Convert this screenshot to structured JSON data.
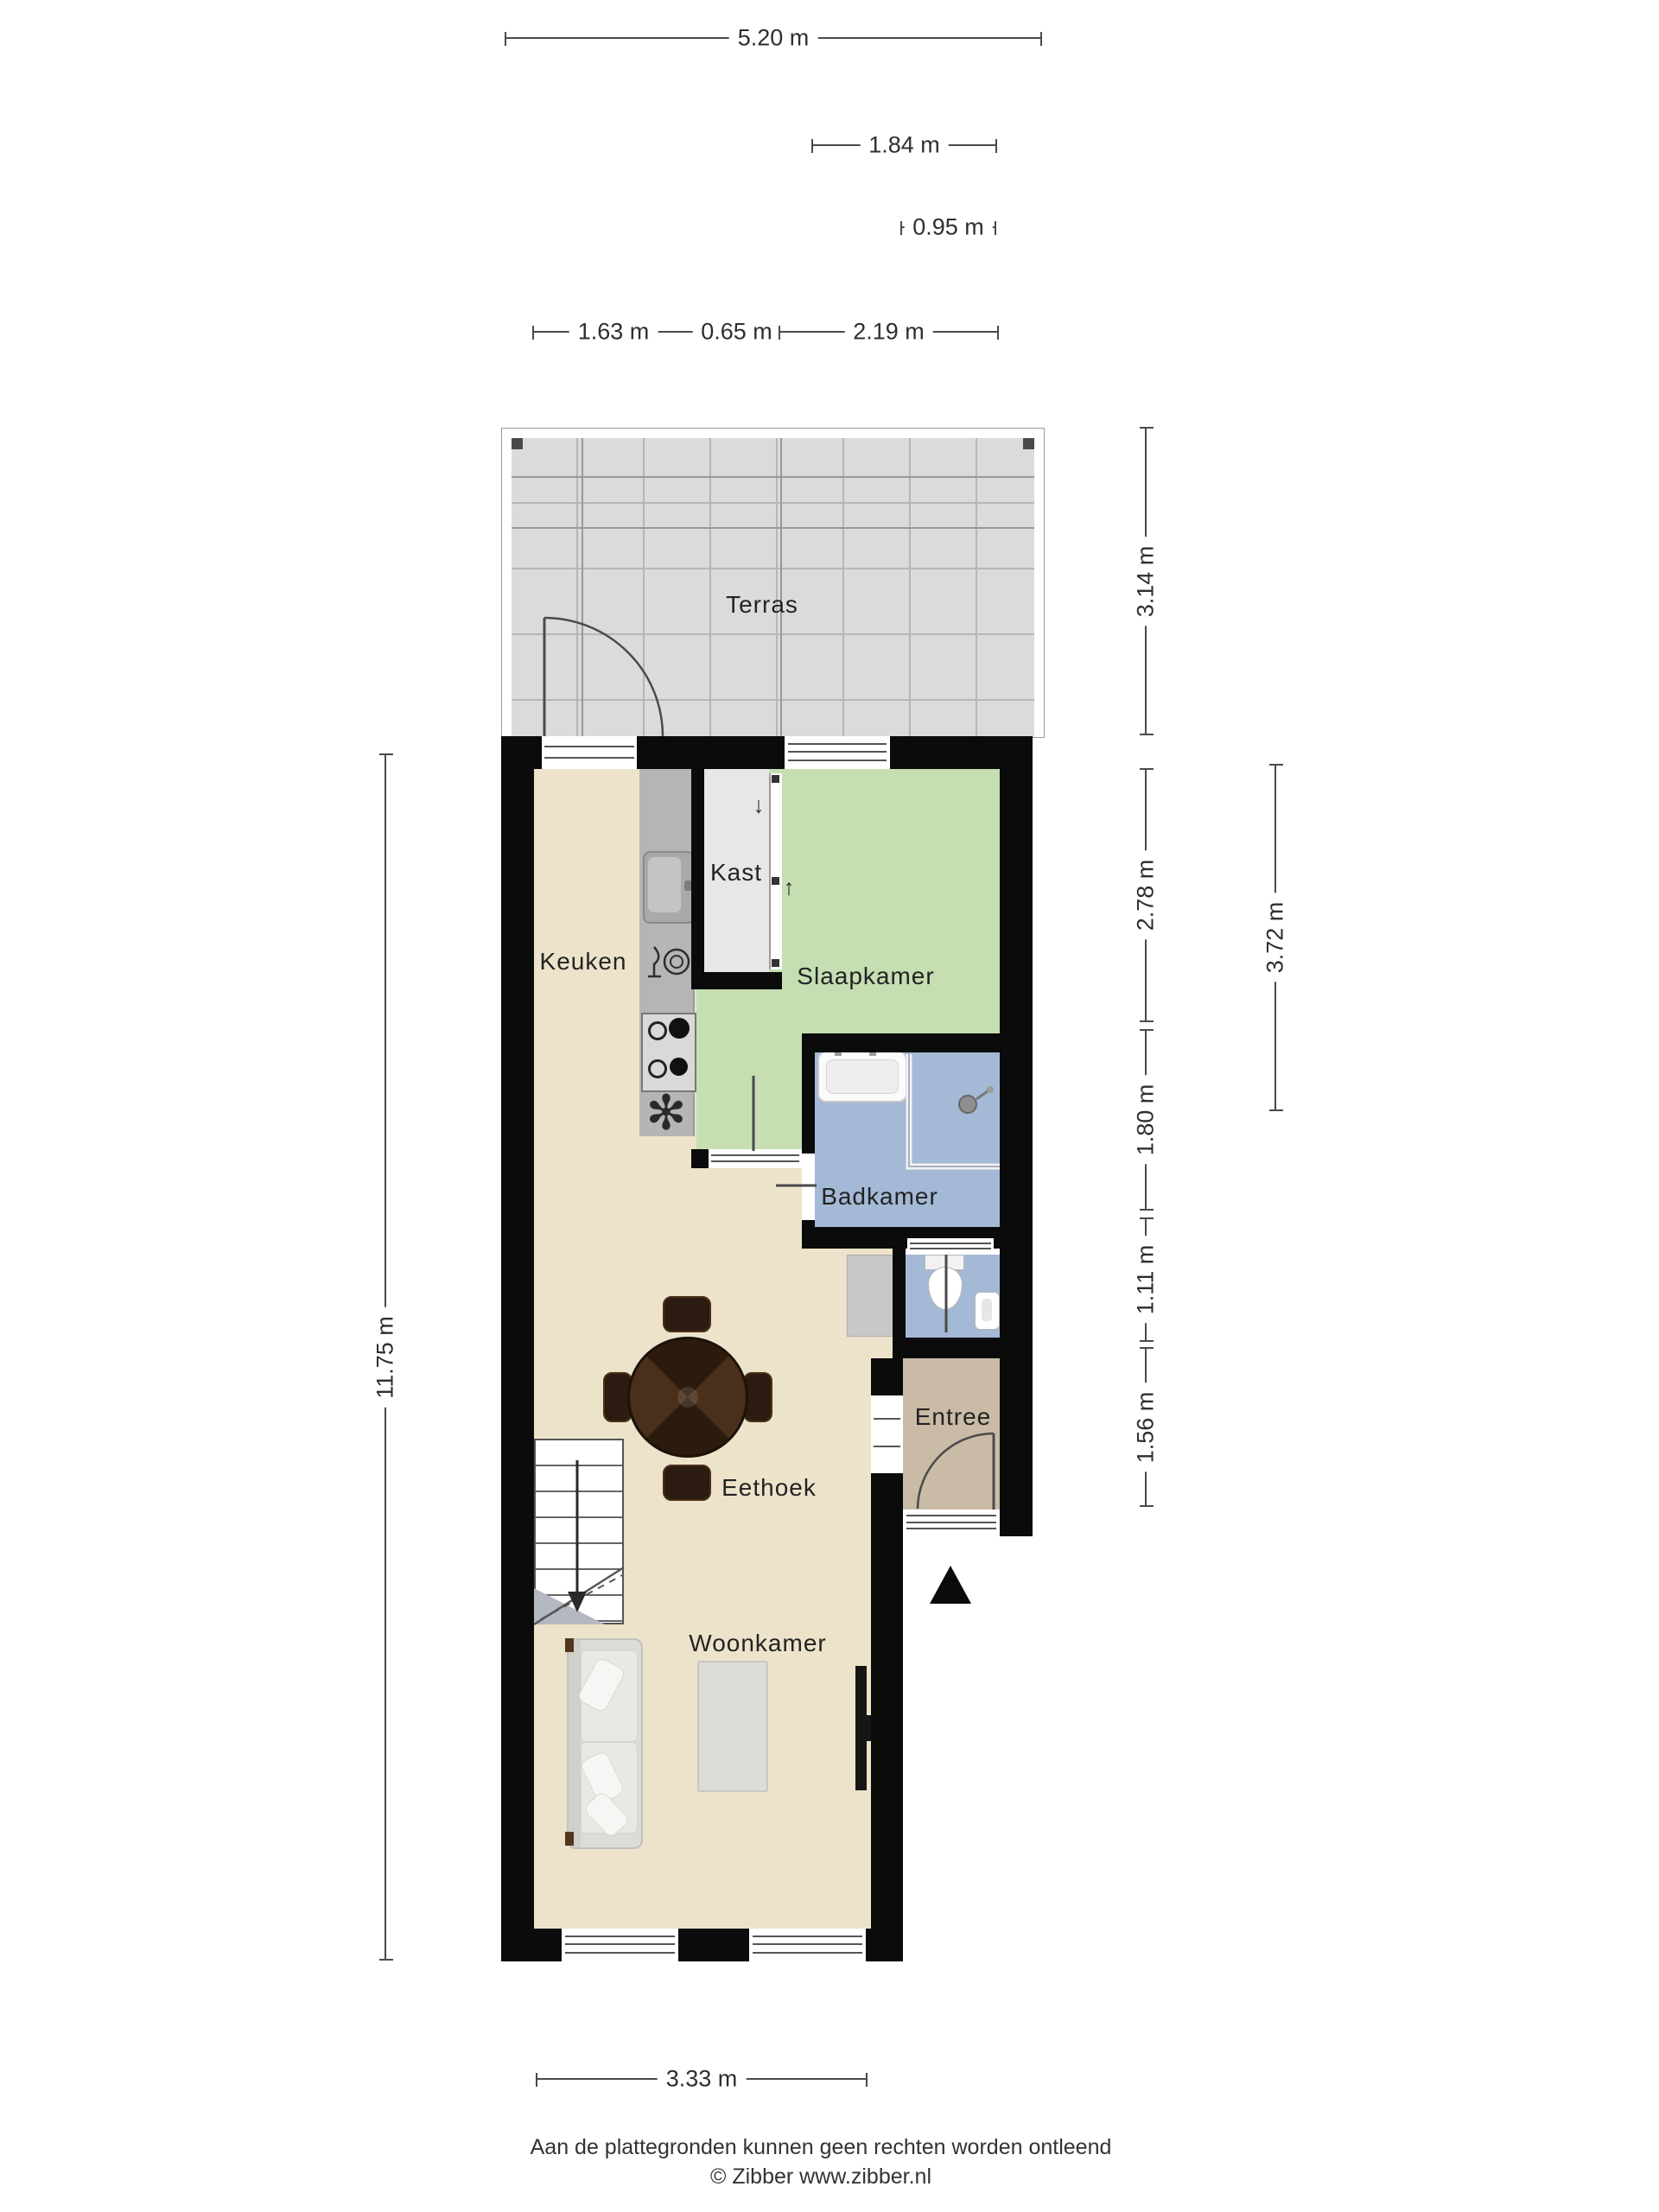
{
  "title": "Floor plan (plattegrond)",
  "rooms": {
    "terras": {
      "label": "Terras",
      "color": "#dbdbdb"
    },
    "keuken": {
      "label": "Keuken",
      "color": "#ece3ca"
    },
    "kast": {
      "label": "Kast",
      "color": "#e7e7e7"
    },
    "slaapkamer": {
      "label": "Slaapkamer",
      "color": "#c5deb2"
    },
    "badkamer": {
      "label": "Badkamer",
      "color": "#a3b9d6"
    },
    "eethoek": {
      "label": "Eethoek",
      "color": "#ece3ca"
    },
    "entree": {
      "label": "Entree",
      "color": "#c9bba6"
    },
    "woonkamer": {
      "label": "Woonkamer",
      "color": "#ece3ca"
    }
  },
  "dims": {
    "d520": "5.20 m",
    "d184": "1.84 m",
    "d095": "0.95 m",
    "d163": "1.63 m",
    "d065": "0.65 m",
    "d219": "2.19 m",
    "d314": "3.14 m",
    "d278": "2.78 m",
    "d180": "1.80 m",
    "d111": "1.11 m",
    "d156": "1.56 m",
    "d372": "3.72 m",
    "d1175": "11.75 m",
    "d333": "3.33 m"
  },
  "glyphs": {
    "closet_arrow_down": "↓",
    "bedroom_arrow_up": "↑",
    "extractor_fan": "✻"
  },
  "colors": {
    "wall": "#0b0b0b",
    "floor": "#ece3ca",
    "bedroom_green": "#c5deb2",
    "bath_blue": "#a3b9d6",
    "entry_tan": "#c9bba6",
    "terrace_grey": "#dbdbdb",
    "counter_grey": "#b5b5b5",
    "table_wood": "#3a2416"
  },
  "footer": {
    "disclaimer": "Aan de plattegronden kunnen geen rechten worden ontleend",
    "copyright": "© Zibber www.zibber.nl"
  }
}
